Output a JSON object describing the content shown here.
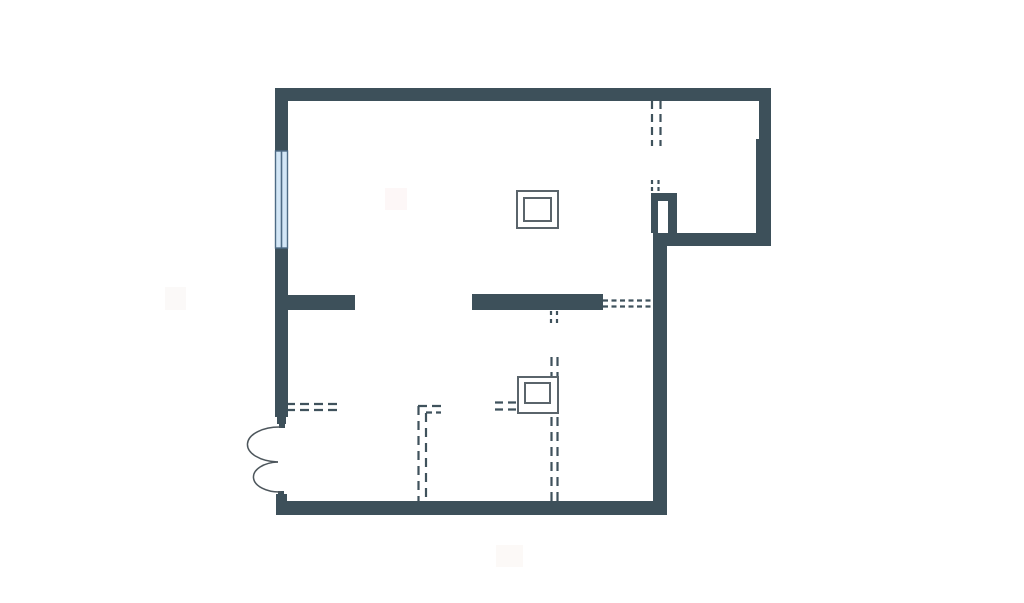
{
  "meta": {
    "description": "Architectural floor plan drawing on white background",
    "canvas": {
      "width": 1024,
      "height": 603
    }
  },
  "colors": {
    "background": "#ffffff",
    "wall": "#3d505a",
    "dash": "#3f525c",
    "symbol_stroke": "#5a646b",
    "symbol_fill": "#ffffff",
    "door_arc": "#4d565c",
    "window_fill": "#d3e6f6",
    "window_frame": "#4e6b85"
  },
  "plan": {
    "walls": [
      {
        "name": "wall-top",
        "x": 275,
        "y": 88,
        "w": 496,
        "h": 13
      },
      {
        "name": "wall-left-upper",
        "x": 275,
        "y": 101,
        "w": 13,
        "h": 50
      },
      {
        "name": "wall-left-main",
        "x": 275,
        "y": 248,
        "w": 13,
        "h": 169
      },
      {
        "name": "door-jamb-top-a",
        "x": 277,
        "y": 417,
        "w": 9,
        "h": 7
      },
      {
        "name": "door-jamb-top-b",
        "x": 279,
        "y": 424,
        "w": 6,
        "h": 4
      },
      {
        "name": "door-jamb-bottom-a",
        "x": 278,
        "y": 491,
        "w": 6,
        "h": 4
      },
      {
        "name": "door-jamb-bottom-b",
        "x": 276,
        "y": 494,
        "w": 11,
        "h": 8
      },
      {
        "name": "wall-right-upper",
        "x": 759,
        "y": 101,
        "w": 12,
        "h": 38
      },
      {
        "name": "wall-right-mid",
        "x": 756,
        "y": 139,
        "w": 15,
        "h": 107
      },
      {
        "name": "wall-alcove-bottom",
        "x": 653,
        "y": 233,
        "w": 118,
        "h": 13
      },
      {
        "name": "shaft-wall-left",
        "x": 651,
        "y": 193,
        "w": 7,
        "h": 40
      },
      {
        "name": "shaft-wall-top",
        "x": 651,
        "y": 193,
        "w": 26,
        "h": 8
      },
      {
        "name": "shaft-wall-right",
        "x": 668,
        "y": 193,
        "w": 9,
        "h": 40
      },
      {
        "name": "wall-center-vertical",
        "x": 653,
        "y": 246,
        "w": 14,
        "h": 269
      },
      {
        "name": "wall-bottom",
        "x": 276,
        "y": 501,
        "w": 391,
        "h": 14
      },
      {
        "name": "wall-stub-left",
        "x": 288,
        "y": 295,
        "w": 67,
        "h": 15
      },
      {
        "name": "wall-partition-mid",
        "x": 472,
        "y": 294,
        "w": 131,
        "h": 16
      }
    ],
    "window": {
      "name": "window-left",
      "x": 275.5,
      "y": 151,
      "w": 12,
      "h": 97
    },
    "door": {
      "name": "double-swing-door",
      "arcs": [
        "M 281 427 A 32 17.5 0 0 0 278 462",
        "M 278 462 A 26 15 0 0 0 281 492"
      ]
    },
    "dashed_lines": [
      {
        "name": "dashed-opening-topright-a",
        "x1": 652,
        "y1": 101,
        "x2": 652,
        "y2": 146,
        "dash": "8 5"
      },
      {
        "name": "dashed-opening-topright-b",
        "x1": 660.5,
        "y1": 101,
        "x2": 660.5,
        "y2": 146,
        "dash": "8 5"
      },
      {
        "name": "dashed-shaft-gap-a",
        "x1": 652,
        "y1": 180,
        "x2": 652,
        "y2": 192,
        "dash": "4 3"
      },
      {
        "name": "dashed-shaft-gap-b",
        "x1": 658.5,
        "y1": 180,
        "x2": 658.5,
        "y2": 192,
        "dash": "4 3"
      },
      {
        "name": "dashed-link-midwall-a",
        "x1": 603,
        "y1": 300.5,
        "x2": 654,
        "y2": 300.5,
        "dash": "5 3.5"
      },
      {
        "name": "dashed-link-midwall-b",
        "x1": 603,
        "y1": 306.5,
        "x2": 654,
        "y2": 306.5,
        "dash": "5 3.5"
      },
      {
        "name": "dashed-below-midwall-a",
        "x1": 551,
        "y1": 311,
        "x2": 551,
        "y2": 326,
        "dash": "4 4"
      },
      {
        "name": "dashed-below-midwall-b",
        "x1": 557,
        "y1": 311,
        "x2": 557,
        "y2": 326,
        "dash": "4 4"
      },
      {
        "name": "dashed-vertical-center-a",
        "x1": 551.5,
        "y1": 357,
        "x2": 551.5,
        "y2": 501,
        "dash": "9 6"
      },
      {
        "name": "dashed-vertical-center-b",
        "x1": 557.5,
        "y1": 357,
        "x2": 557.5,
        "y2": 501,
        "dash": "9 6"
      },
      {
        "name": "dashed-into-symbol-a",
        "x1": 495,
        "y1": 402.5,
        "x2": 518,
        "y2": 402.5,
        "dash": "8 5"
      },
      {
        "name": "dashed-into-symbol-b",
        "x1": 495,
        "y1": 409.5,
        "x2": 518,
        "y2": 409.5,
        "dash": "8 5"
      },
      {
        "name": "dashed-from-leftwall-a",
        "x1": 286,
        "y1": 404,
        "x2": 341,
        "y2": 404,
        "dash": "9 5"
      },
      {
        "name": "dashed-from-leftwall-b",
        "x1": 286,
        "y1": 410,
        "x2": 341,
        "y2": 410,
        "dash": "9 5"
      },
      {
        "name": "dashed-lshape-vertical-a",
        "x1": 418.5,
        "y1": 406,
        "x2": 418.5,
        "y2": 501,
        "dash": "9 6"
      },
      {
        "name": "dashed-lshape-vertical-b",
        "x1": 426,
        "y1": 413,
        "x2": 426,
        "y2": 501,
        "dash": "9 6"
      },
      {
        "name": "dashed-lshape-horizontal-a",
        "x1": 418,
        "y1": 406,
        "x2": 441,
        "y2": 406,
        "dash": "9 5"
      },
      {
        "name": "dashed-lshape-horizontal-b",
        "x1": 426,
        "y1": 412.5,
        "x2": 441,
        "y2": 412.5,
        "dash": "6 4"
      }
    ],
    "squares": [
      {
        "name": "symbol-square-upper",
        "outer": {
          "x": 517,
          "y": 191,
          "w": 41,
          "h": 37
        },
        "inner": {
          "x": 524,
          "y": 198,
          "w": 27,
          "h": 23
        }
      },
      {
        "name": "symbol-square-lower",
        "outer": {
          "x": 518,
          "y": 377,
          "w": 40,
          "h": 36
        },
        "inner": {
          "x": 525,
          "y": 383,
          "w": 25,
          "h": 20
        }
      }
    ],
    "watermarks": [
      {
        "name": "watermark-left",
        "x": 165,
        "y": 287,
        "w": 21,
        "h": 23,
        "color": "#fbf9f8"
      },
      {
        "name": "watermark-top",
        "x": 385,
        "y": 188,
        "w": 22,
        "h": 22,
        "color": "#fdf7f7"
      },
      {
        "name": "watermark-bottom",
        "x": 496,
        "y": 545,
        "w": 27,
        "h": 22,
        "color": "#fcf9f7"
      }
    ]
  }
}
